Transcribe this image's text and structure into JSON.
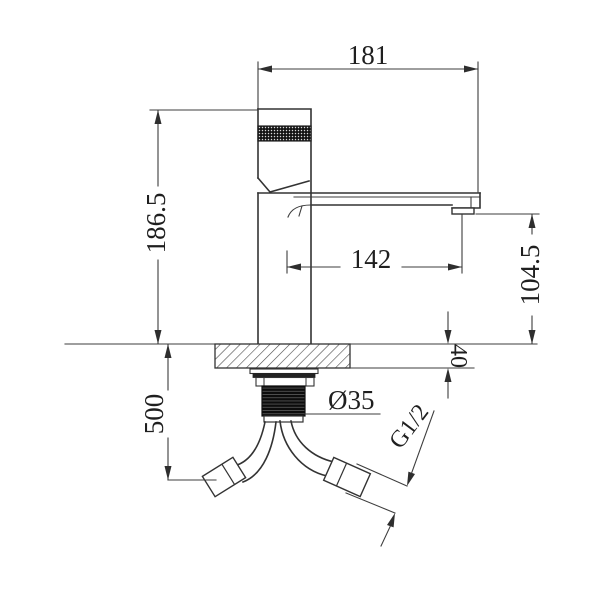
{
  "drawing": {
    "units": "mm",
    "dims": {
      "width_overall": "181",
      "height_overall": "186.5",
      "spout_reach": "142",
      "spout_height": "104.5",
      "deck_thickness": "40",
      "hose_drop": "500",
      "hole_diameter": "Ø35",
      "thread": "G1/2"
    }
  }
}
